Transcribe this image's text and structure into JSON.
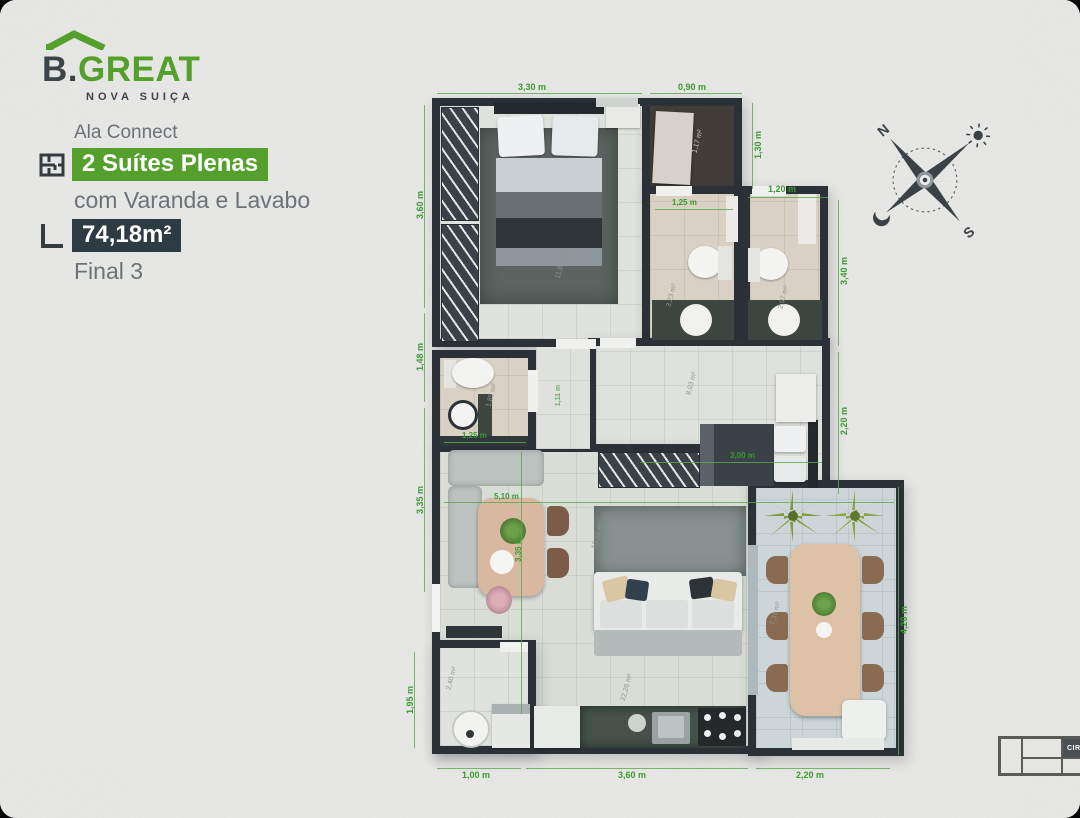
{
  "logo": {
    "brand_b": "B.",
    "brand_great": "GREAT",
    "subtitle": "NOVA SUIÇA",
    "green": "#55a02c",
    "dark": "#3c444a"
  },
  "info": {
    "line1": "Ala Connect",
    "highlight": "2 Suítes Plenas",
    "line2": "com Varanda e Lavabo",
    "area_badge": "74,18m²",
    "line3": "Final 3",
    "highlight_bg": "#55a02c",
    "area_bg": "#2c3b44"
  },
  "compass": {
    "north": "N",
    "south": "S"
  },
  "plan": {
    "accent_green": "#3c9a33",
    "wall_color": "#2b3137",
    "dims": [
      "3,30 m",
      "0,90 m",
      "1,30 m",
      "1,20 m",
      "3,40 m",
      "2,20 m",
      "4,20 m",
      "3,60 m",
      "1,48 m",
      "3,35 m",
      "1,95 m",
      "1,00 m",
      "3,60 m",
      "2,20 m",
      "1,25 m",
      "1,25 m",
      "3,00 m",
      "5,10 m",
      "3,35 m",
      "1,11 m"
    ],
    "areas": [
      "1,17 m²",
      "11,88 m²",
      "3,23 m²",
      "2,97 m²",
      "1,85 m²",
      "8,03 m²",
      "10,92 m²",
      "22,26 m²",
      "7,31 m²",
      "2,40 m²"
    ]
  },
  "keyplan": {
    "label": "CIRCULAÇÃO"
  }
}
